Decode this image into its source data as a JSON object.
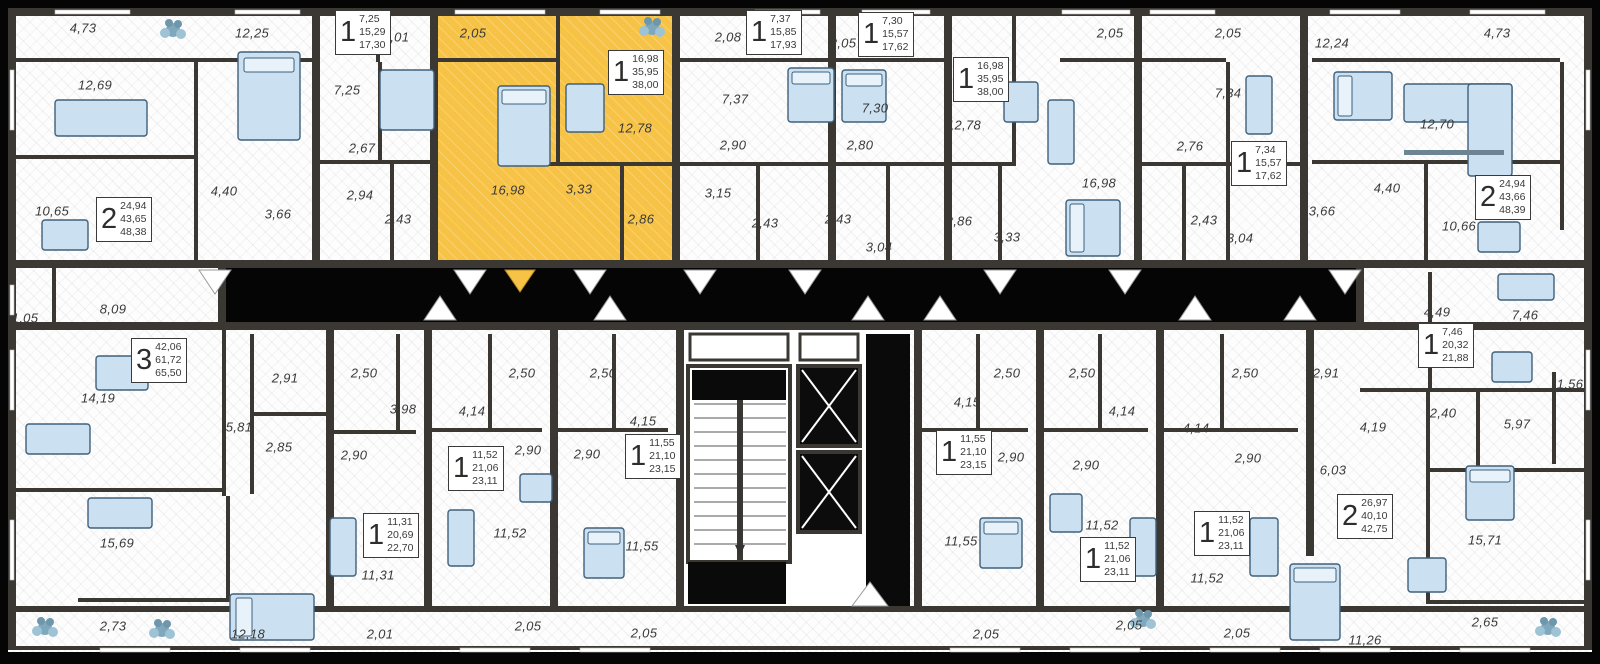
{
  "plan": {
    "title": "residential-floor-plan",
    "colors": {
      "background": "#050505",
      "wall": "#3B3733",
      "floor": "#FDFDFD",
      "highlight": "#F7C347",
      "furniture_fill": "#CBE0F0",
      "furniture_stroke": "#3F607A",
      "label_text": "#3A3A39"
    },
    "selected_unit": {
      "rooms": "1",
      "areas": [
        "16,98",
        "35,95",
        "38,00"
      ]
    },
    "units": [
      {
        "rooms": "2",
        "areas": [
          "24,94",
          "43,65",
          "48,38"
        ],
        "x": 96,
        "y": 197,
        "highlighted": false
      },
      {
        "rooms": "1",
        "areas": [
          "7,25",
          "15,29",
          "17,30"
        ],
        "x": 335,
        "y": 10,
        "highlighted": false
      },
      {
        "rooms": "1",
        "areas": [
          "16,98",
          "35,95",
          "38,00"
        ],
        "x": 608,
        "y": 50,
        "highlighted": true
      },
      {
        "rooms": "1",
        "areas": [
          "7,37",
          "15,85",
          "17,93"
        ],
        "x": 746,
        "y": 10,
        "highlighted": false
      },
      {
        "rooms": "1",
        "areas": [
          "7,30",
          "15,57",
          "17,62"
        ],
        "x": 858,
        "y": 12,
        "highlighted": false
      },
      {
        "rooms": "1",
        "areas": [
          "16,98",
          "35,95",
          "38,00"
        ],
        "x": 953,
        "y": 57,
        "highlighted": false
      },
      {
        "rooms": "1",
        "areas": [
          "7,34",
          "15,57",
          "17,62"
        ],
        "x": 1231,
        "y": 141,
        "highlighted": false
      },
      {
        "rooms": "2",
        "areas": [
          "24,94",
          "43,66",
          "48,39"
        ],
        "x": 1475,
        "y": 175,
        "highlighted": false
      },
      {
        "rooms": "3",
        "areas": [
          "42,06",
          "61,72",
          "65,50"
        ],
        "x": 131,
        "y": 338,
        "highlighted": false
      },
      {
        "rooms": "1",
        "areas": [
          "11,31",
          "20,69",
          "22,70"
        ],
        "x": 363,
        "y": 513,
        "highlighted": false
      },
      {
        "rooms": "1",
        "areas": [
          "11,52",
          "21,06",
          "23,11"
        ],
        "x": 448,
        "y": 446,
        "highlighted": false
      },
      {
        "rooms": "1",
        "areas": [
          "11,55",
          "21,10",
          "23,15"
        ],
        "x": 625,
        "y": 434,
        "highlighted": false
      },
      {
        "rooms": "1",
        "areas": [
          "11,55",
          "21,10",
          "23,15"
        ],
        "x": 936,
        "y": 430,
        "highlighted": false
      },
      {
        "rooms": "1",
        "areas": [
          "11,52",
          "21,06",
          "23,11"
        ],
        "x": 1080,
        "y": 537,
        "highlighted": false
      },
      {
        "rooms": "1",
        "areas": [
          "11,52",
          "21,06",
          "23,11"
        ],
        "x": 1194,
        "y": 511,
        "highlighted": false
      },
      {
        "rooms": "2",
        "areas": [
          "26,97",
          "40,10",
          "42,75"
        ],
        "x": 1337,
        "y": 494,
        "highlighted": false
      },
      {
        "rooms": "1",
        "areas": [
          "7,46",
          "20,32",
          "21,88"
        ],
        "x": 1418,
        "y": 323,
        "highlighted": false
      }
    ],
    "room_labels": [
      {
        "t": "4,73",
        "x": 83,
        "y": 28
      },
      {
        "t": "12,69",
        "x": 95,
        "y": 85
      },
      {
        "t": "10,65",
        "x": 52,
        "y": 211
      },
      {
        "t": "12,25",
        "x": 252,
        "y": 33
      },
      {
        "t": "2,01",
        "x": 396,
        "y": 37
      },
      {
        "t": "7,25",
        "x": 347,
        "y": 90
      },
      {
        "t": "2,67",
        "x": 362,
        "y": 148
      },
      {
        "t": "2,94",
        "x": 360,
        "y": 195
      },
      {
        "t": "3,66",
        "x": 278,
        "y": 214
      },
      {
        "t": "2,43",
        "x": 398,
        "y": 219
      },
      {
        "t": "4,40",
        "x": 224,
        "y": 191
      },
      {
        "t": "2,05",
        "x": 473,
        "y": 33
      },
      {
        "t": "16,98",
        "x": 508,
        "y": 190
      },
      {
        "t": "12,78",
        "x": 635,
        "y": 128
      },
      {
        "t": "3,33",
        "x": 579,
        "y": 189
      },
      {
        "t": "2,86",
        "x": 641,
        "y": 219
      },
      {
        "t": "2,08",
        "x": 728,
        "y": 37
      },
      {
        "t": "7,37",
        "x": 735,
        "y": 99
      },
      {
        "t": "2,90",
        "x": 733,
        "y": 145
      },
      {
        "t": "3,15",
        "x": 718,
        "y": 193
      },
      {
        "t": "2,43",
        "x": 765,
        "y": 223
      },
      {
        "t": "2,05",
        "x": 843,
        "y": 43
      },
      {
        "t": "7,30",
        "x": 875,
        "y": 108
      },
      {
        "t": "2,80",
        "x": 860,
        "y": 145
      },
      {
        "t": "2,43",
        "x": 838,
        "y": 219
      },
      {
        "t": "3,04",
        "x": 879,
        "y": 247
      },
      {
        "t": "12,78",
        "x": 964,
        "y": 125
      },
      {
        "t": "2,86",
        "x": 959,
        "y": 221
      },
      {
        "t": "3,33",
        "x": 1007,
        "y": 237
      },
      {
        "t": "16,98",
        "x": 1099,
        "y": 183
      },
      {
        "t": "2,05",
        "x": 1110,
        "y": 33
      },
      {
        "t": "2,76",
        "x": 1190,
        "y": 146
      },
      {
        "t": "2,43",
        "x": 1204,
        "y": 220
      },
      {
        "t": "2,05",
        "x": 1228,
        "y": 33
      },
      {
        "t": "7,34",
        "x": 1228,
        "y": 93
      },
      {
        "t": "12,24",
        "x": 1332,
        "y": 43
      },
      {
        "t": "3,66",
        "x": 1322,
        "y": 211
      },
      {
        "t": "4,40",
        "x": 1387,
        "y": 188
      },
      {
        "t": "3,04",
        "x": 1240,
        "y": 238
      },
      {
        "t": "4,73",
        "x": 1497,
        "y": 33
      },
      {
        "t": "12,70",
        "x": 1437,
        "y": 124
      },
      {
        "t": "10,66",
        "x": 1459,
        "y": 226
      },
      {
        "t": "1,05",
        "x": 25,
        "y": 318
      },
      {
        "t": "8,09",
        "x": 113,
        "y": 309
      },
      {
        "t": "4,49",
        "x": 1437,
        "y": 312
      },
      {
        "t": "7,46",
        "x": 1525,
        "y": 315
      },
      {
        "t": "14,19",
        "x": 98,
        "y": 398
      },
      {
        "t": "2,91",
        "x": 285,
        "y": 378
      },
      {
        "t": "2,50",
        "x": 364,
        "y": 373
      },
      {
        "t": "5,81",
        "x": 239,
        "y": 427
      },
      {
        "t": "2,85",
        "x": 279,
        "y": 447
      },
      {
        "t": "2,90",
        "x": 354,
        "y": 455
      },
      {
        "t": "3,98",
        "x": 403,
        "y": 409
      },
      {
        "t": "15,69",
        "x": 117,
        "y": 543
      },
      {
        "t": "11,31",
        "x": 378,
        "y": 575
      },
      {
        "t": "2,73",
        "x": 113,
        "y": 626
      },
      {
        "t": "12,18",
        "x": 248,
        "y": 634
      },
      {
        "t": "2,01",
        "x": 380,
        "y": 634
      },
      {
        "t": "4,14",
        "x": 472,
        "y": 411
      },
      {
        "t": "2,50",
        "x": 522,
        "y": 373
      },
      {
        "t": "2,90",
        "x": 528,
        "y": 450
      },
      {
        "t": "11,52",
        "x": 510,
        "y": 533
      },
      {
        "t": "2,05",
        "x": 528,
        "y": 626
      },
      {
        "t": "2,50",
        "x": 603,
        "y": 373
      },
      {
        "t": "2,90",
        "x": 587,
        "y": 454
      },
      {
        "t": "4,15",
        "x": 643,
        "y": 421
      },
      {
        "t": "11,55",
        "x": 642,
        "y": 546
      },
      {
        "t": "2,05",
        "x": 644,
        "y": 633
      },
      {
        "t": "4,15",
        "x": 967,
        "y": 402
      },
      {
        "t": "2,50",
        "x": 1007,
        "y": 373
      },
      {
        "t": "2,90",
        "x": 1011,
        "y": 457
      },
      {
        "t": "11,55",
        "x": 961,
        "y": 541
      },
      {
        "t": "2,05",
        "x": 986,
        "y": 634
      },
      {
        "t": "2,50",
        "x": 1082,
        "y": 373
      },
      {
        "t": "4,14",
        "x": 1122,
        "y": 411
      },
      {
        "t": "2,90",
        "x": 1086,
        "y": 465
      },
      {
        "t": "11,52",
        "x": 1102,
        "y": 525
      },
      {
        "t": "2,05",
        "x": 1129,
        "y": 625
      },
      {
        "t": "2,50",
        "x": 1245,
        "y": 373
      },
      {
        "t": "2,91",
        "x": 1326,
        "y": 373
      },
      {
        "t": "4,14",
        "x": 1196,
        "y": 428
      },
      {
        "t": "2,90",
        "x": 1248,
        "y": 458
      },
      {
        "t": "11,52",
        "x": 1207,
        "y": 578
      },
      {
        "t": "2,05",
        "x": 1237,
        "y": 633
      },
      {
        "t": "4,19",
        "x": 1373,
        "y": 427
      },
      {
        "t": "2,40",
        "x": 1443,
        "y": 413
      },
      {
        "t": "5,97",
        "x": 1517,
        "y": 424
      },
      {
        "t": "1,56",
        "x": 1570,
        "y": 384
      },
      {
        "t": "6,03",
        "x": 1333,
        "y": 470
      },
      {
        "t": "15,71",
        "x": 1485,
        "y": 540
      },
      {
        "t": "2,65",
        "x": 1485,
        "y": 622
      },
      {
        "t": "11,26",
        "x": 1365,
        "y": 640
      }
    ]
  }
}
